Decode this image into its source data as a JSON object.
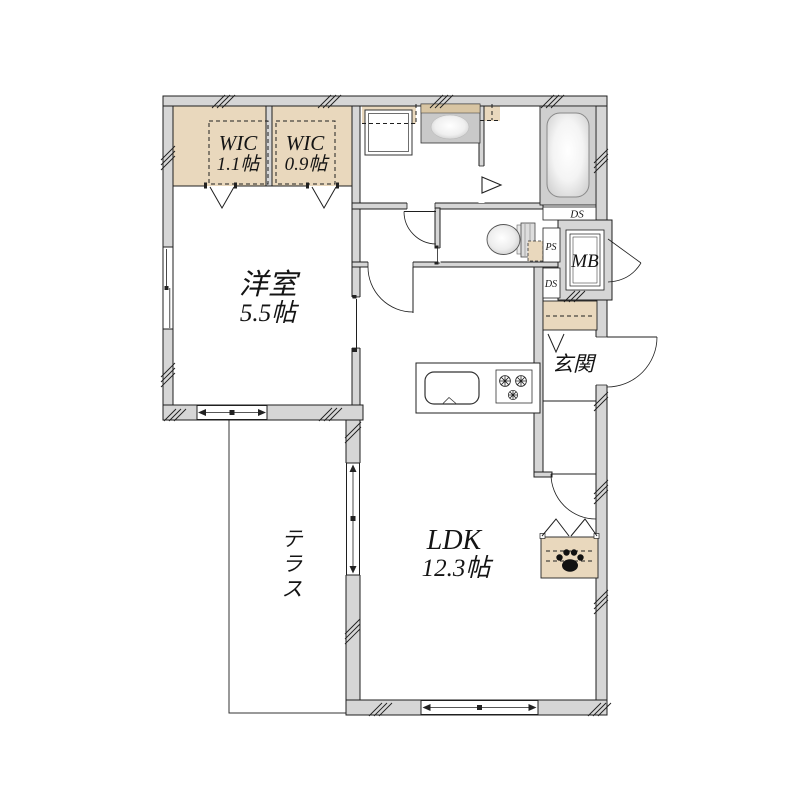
{
  "floorplan": {
    "rooms": {
      "wic1": {
        "label": "WIC",
        "size": "1.1帖"
      },
      "wic2": {
        "label": "WIC",
        "size": "0.9帖"
      },
      "western_room": {
        "label": "洋室",
        "size": "5.5帖"
      },
      "ldk": {
        "label": "LDK",
        "size": "12.3帖"
      },
      "terrace": {
        "label": "テラス",
        "chars": [
          "テ",
          "ラ",
          "ス"
        ]
      },
      "entrance": {
        "label": "玄関"
      }
    },
    "labels": {
      "mb": "MB",
      "ds_top": "DS",
      "ps": "PS",
      "ds_bottom": "DS"
    },
    "fixtures": [
      "bathtub-icon",
      "toilet-icon",
      "washbasin-icon",
      "washing-machine-icon",
      "kitchen-sink-icon",
      "stove-burners-icon",
      "paw-print-icon"
    ],
    "colors": {
      "wall_fill": "#d6d6d6",
      "closet_beige": "#e9d8bd",
      "counter_band_beige": "#d8c5a3",
      "bath_surround": "#cfcfcf",
      "line": "#1f1f1f",
      "background": "#ffffff"
    }
  }
}
